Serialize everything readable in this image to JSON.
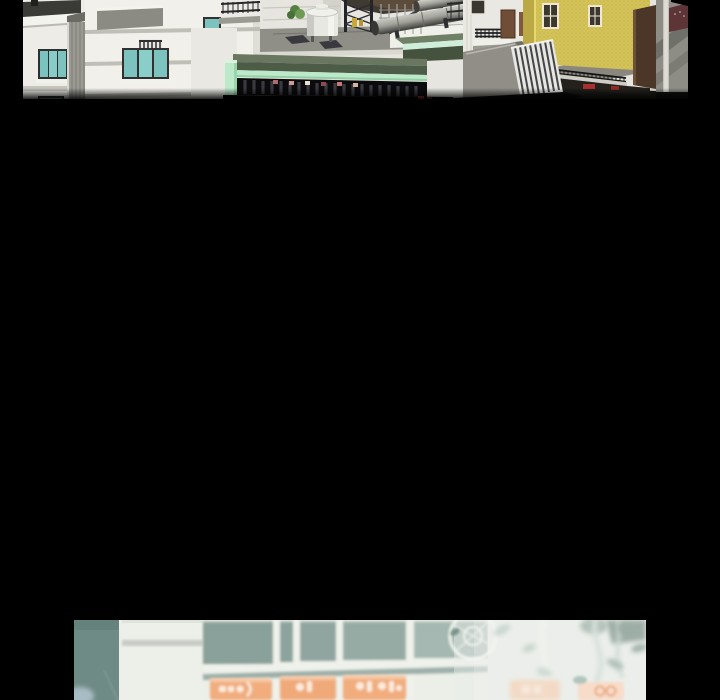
{
  "reader": {
    "kind": "webtoon-vertical-scroll-view",
    "background_color": "#000000",
    "visible_panel_count": 2,
    "gutter_color": "#000000"
  },
  "panels": {
    "top": {
      "alt": "3D architectural render of a city block seen from a rooftop: white apartment buildings with teal glass windows on the left, a green-roofed pavilion edged with mint trim over dark slatted shopfronts, a rooftop with a white water tank, lattice towers and large metal duct cylinders, a textured yellow building with dark-framed windows and a black railing, and a gray stair block with a maroon sign at far right",
      "colors": {
        "facade_white": "#f1f0ea",
        "window_teal": "#7cc3bf",
        "roof_green": "#50604a",
        "mint_trim": "#bce9c9",
        "yellow_building": "#d4c358",
        "rooftop_gray": "#8f8f88",
        "shadow_black": "#030303"
      }
    },
    "bottom": {
      "alt": "Blurred illustrated storefront: a grid of gray-teal window panes with white mullions, a row of orange signboards with illegible white lettering, washed-out pale area to the right with faint branches, leaves and a bicycle wheel, and a peach sign with faint orange characters in the lower right corner",
      "colors": {
        "pane_teal": "#8aa09a",
        "mullion_white": "#eff1eb",
        "sign_orange": "#f1ad7e",
        "sign_peach": "#f9d5bd",
        "wash_white": "#eceee8",
        "leaf_teal": "#7f968e"
      }
    }
  }
}
